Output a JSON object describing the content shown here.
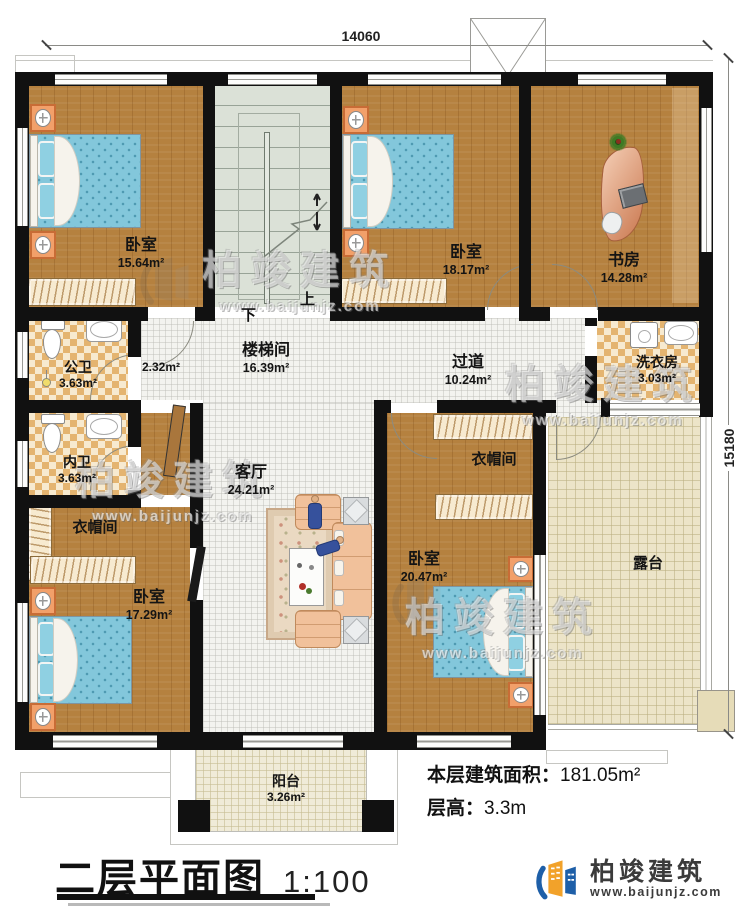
{
  "title": {
    "text": "二层平面图",
    "scale": "1:100"
  },
  "dimensions": {
    "width": "14060",
    "height": "15180"
  },
  "annotations": {
    "floor_area_label": "本层建筑面积：",
    "floor_area_value": "181.05m²",
    "floor_height_label": "层高：",
    "floor_height_value": "3.3m"
  },
  "rooms": {
    "bedroom_top_left": {
      "name": "卧室",
      "area": "15.64m²"
    },
    "bedroom_top_mid": {
      "name": "卧室",
      "area": "18.17m²"
    },
    "study": {
      "name": "书房",
      "area": "14.28m²"
    },
    "stairwell": {
      "name": "楼梯间",
      "area": "16.39m²"
    },
    "vestibule": {
      "area": "2.32m²"
    },
    "public_bath": {
      "name": "公卫",
      "area": "3.63m²"
    },
    "inner_bath": {
      "name": "内卫",
      "area": "3.63m²"
    },
    "corridor": {
      "name": "过道",
      "area": "10.24m²"
    },
    "laundry": {
      "name": "洗衣房",
      "area": "3.03m²"
    },
    "living": {
      "name": "客厅",
      "area": "24.21m²"
    },
    "cloak_left": {
      "name": "衣帽间"
    },
    "cloak_right": {
      "name": "衣帽间"
    },
    "bedroom_bottom_left": {
      "name": "卧室",
      "area": "17.29m²"
    },
    "bedroom_bottom_right": {
      "name": "卧室",
      "area": "20.47m²"
    },
    "terrace": {
      "name": "露台"
    },
    "balcony": {
      "name": "阳台",
      "area": "3.26m²"
    }
  },
  "stairs": {
    "up": "上",
    "down": "下"
  },
  "watermark": {
    "name": "柏竣建筑",
    "url": "www.baijunjz.com"
  },
  "brand": {
    "name": "柏竣建筑",
    "url": "www.baijunjz.com"
  },
  "colors": {
    "wall": "#111111",
    "wood": "#b5813f",
    "checker_tile": "#e4b470",
    "bed": "#83c7db",
    "stair_floor": "#dbe1d7",
    "logo_blue": "#1e5fa8",
    "logo_orange": "#f2a22a"
  }
}
